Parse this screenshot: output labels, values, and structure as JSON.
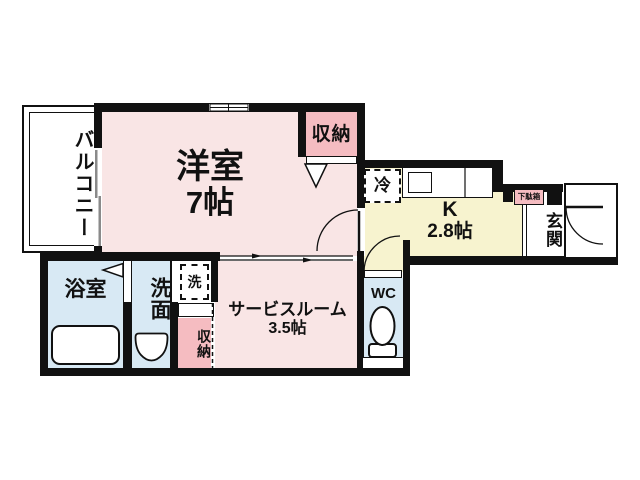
{
  "plan_type": "floor-plan",
  "colors": {
    "room_pink": "#f9e5e5",
    "closet_pink": "#f5bcc1",
    "kitchen_yellow": "#f7f3cf",
    "water_blue": "#d8e9f4",
    "wall_black": "#111111",
    "background": "#ffffff"
  },
  "rooms": {
    "balcony": {
      "label": "バルコニー"
    },
    "western": {
      "name": "洋室",
      "size": "7帖"
    },
    "closet_top": {
      "label": "収納"
    },
    "kitchen": {
      "name": "K",
      "size": "2.8帖"
    },
    "refrigerator": {
      "label": "冷"
    },
    "entrance": {
      "label": "玄関"
    },
    "shoe_cabinet": {
      "label": "下駄箱"
    },
    "bathroom": {
      "label": "浴室"
    },
    "washroom": {
      "label": "洗面"
    },
    "washer": {
      "label": "洗"
    },
    "closet_bottom": {
      "label": "収納"
    },
    "service": {
      "name": "サービスルーム",
      "size": "3.5帖"
    },
    "wc": {
      "label": "WC"
    }
  }
}
